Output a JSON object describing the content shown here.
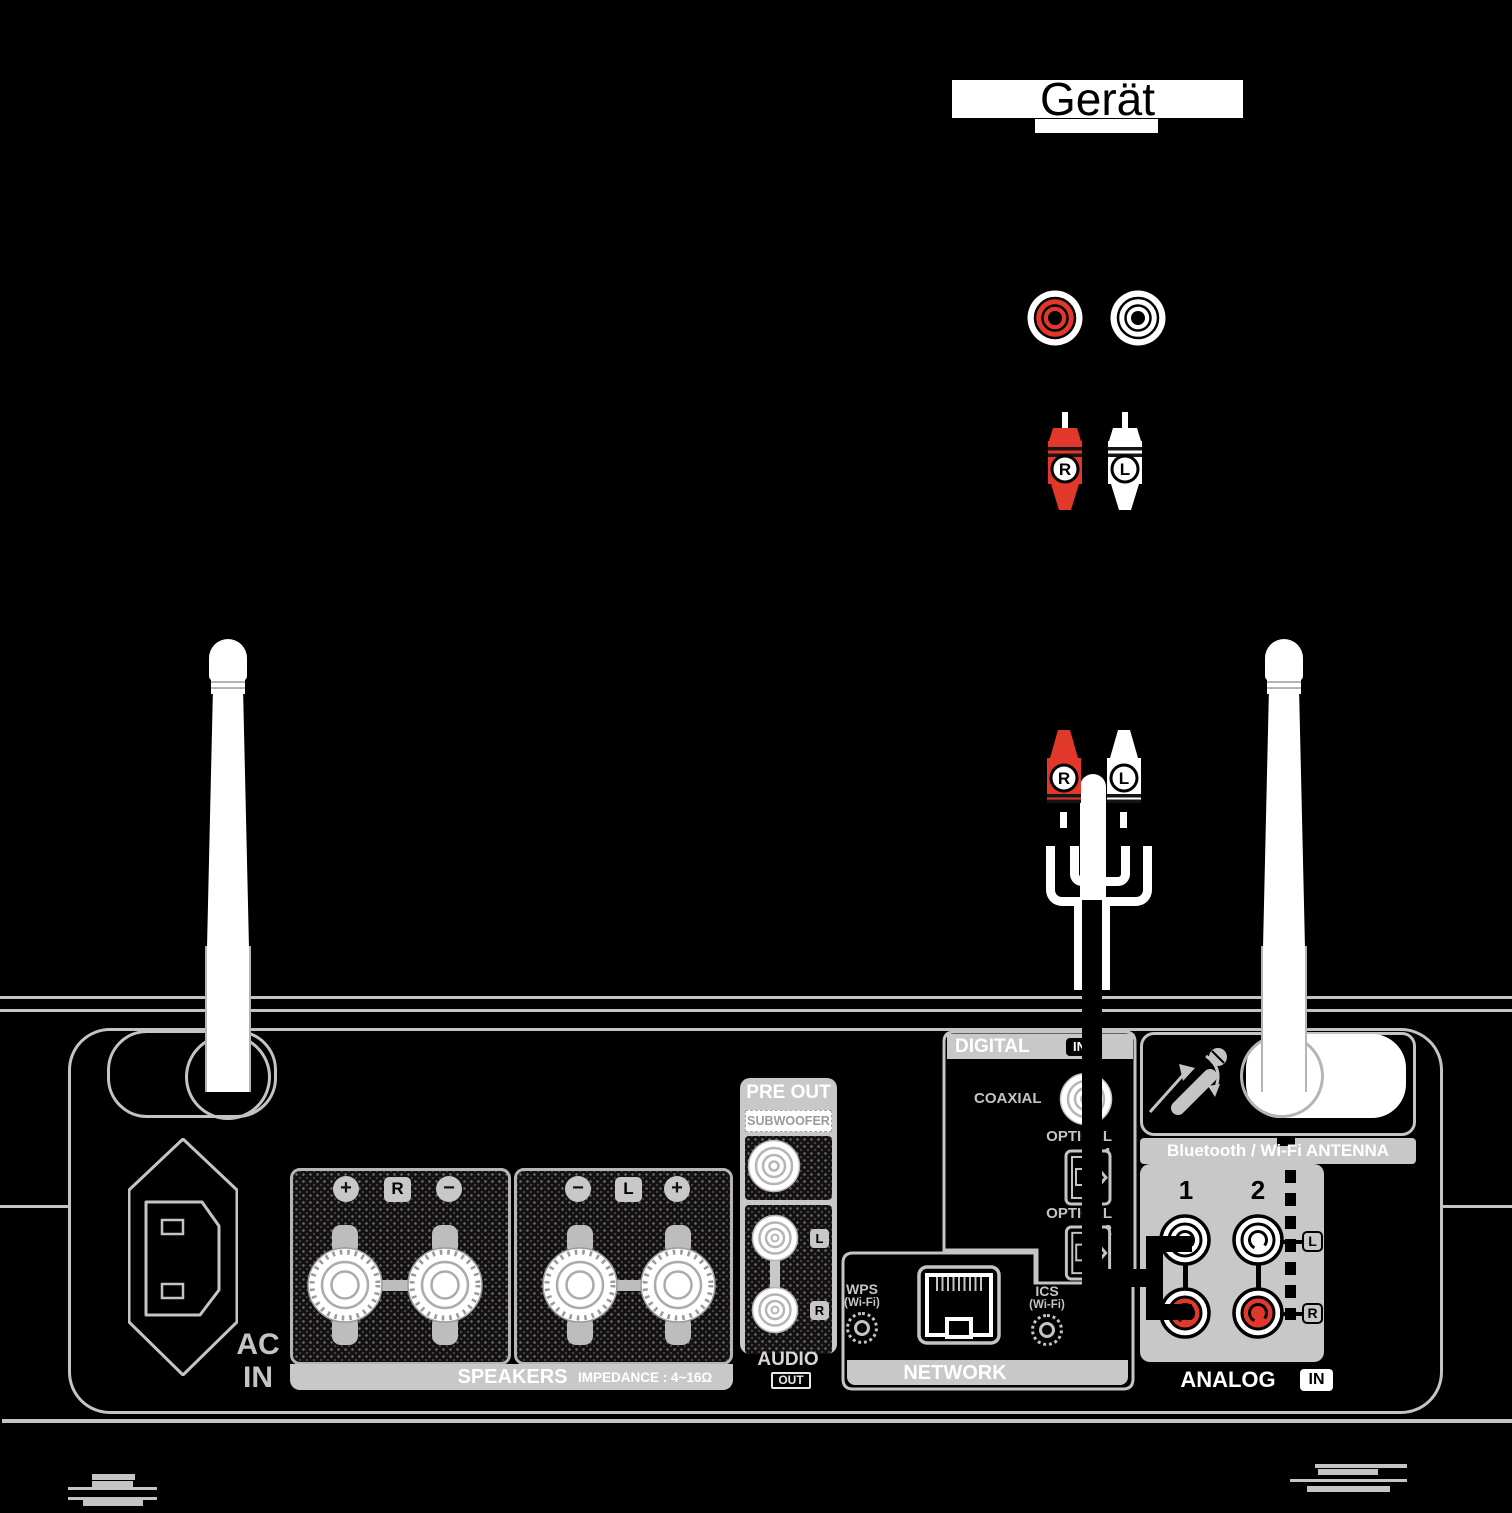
{
  "geraet": {
    "title": "Gerät"
  },
  "plugs": {
    "r": "R",
    "l": "L"
  },
  "ac": {
    "line1": "AC",
    "line2": "IN"
  },
  "speakers": {
    "plus": "+",
    "minus": "−",
    "right": "R",
    "left": "L",
    "title": "SPEAKERS",
    "impedance": "IMPEDANCE : 4~16Ω"
  },
  "pre_out": {
    "title": "PRE OUT",
    "subwoofer": "SUBWOOFER",
    "l": "L",
    "r": "R",
    "audio": "AUDIO",
    "out": "OUT"
  },
  "network": {
    "title": "NETWORK",
    "wps": "WPS",
    "wps_sub": "(Wi-Fi)",
    "ics": "ICS",
    "ics_sub": "(Wi-Fi)"
  },
  "digital": {
    "title": "DIGITAL",
    "in_badge": "IN",
    "coaxial": "COAXIAL",
    "optical1": "OPTICAL 1",
    "optical2": "OPTICAL 2"
  },
  "analog": {
    "title": "ANALOG",
    "in_badge": "IN",
    "num1": "1",
    "num2": "2",
    "l": "L",
    "r": "R"
  },
  "bluetooth": {
    "label": "Bluetooth / Wi-Fi ANTENNA"
  },
  "colors": {
    "background": "#000000",
    "accent_red": "#e2382b",
    "panel_gray": "#c8c8c8",
    "line_gray": "#c4c4c4",
    "white": "#ffffff"
  }
}
